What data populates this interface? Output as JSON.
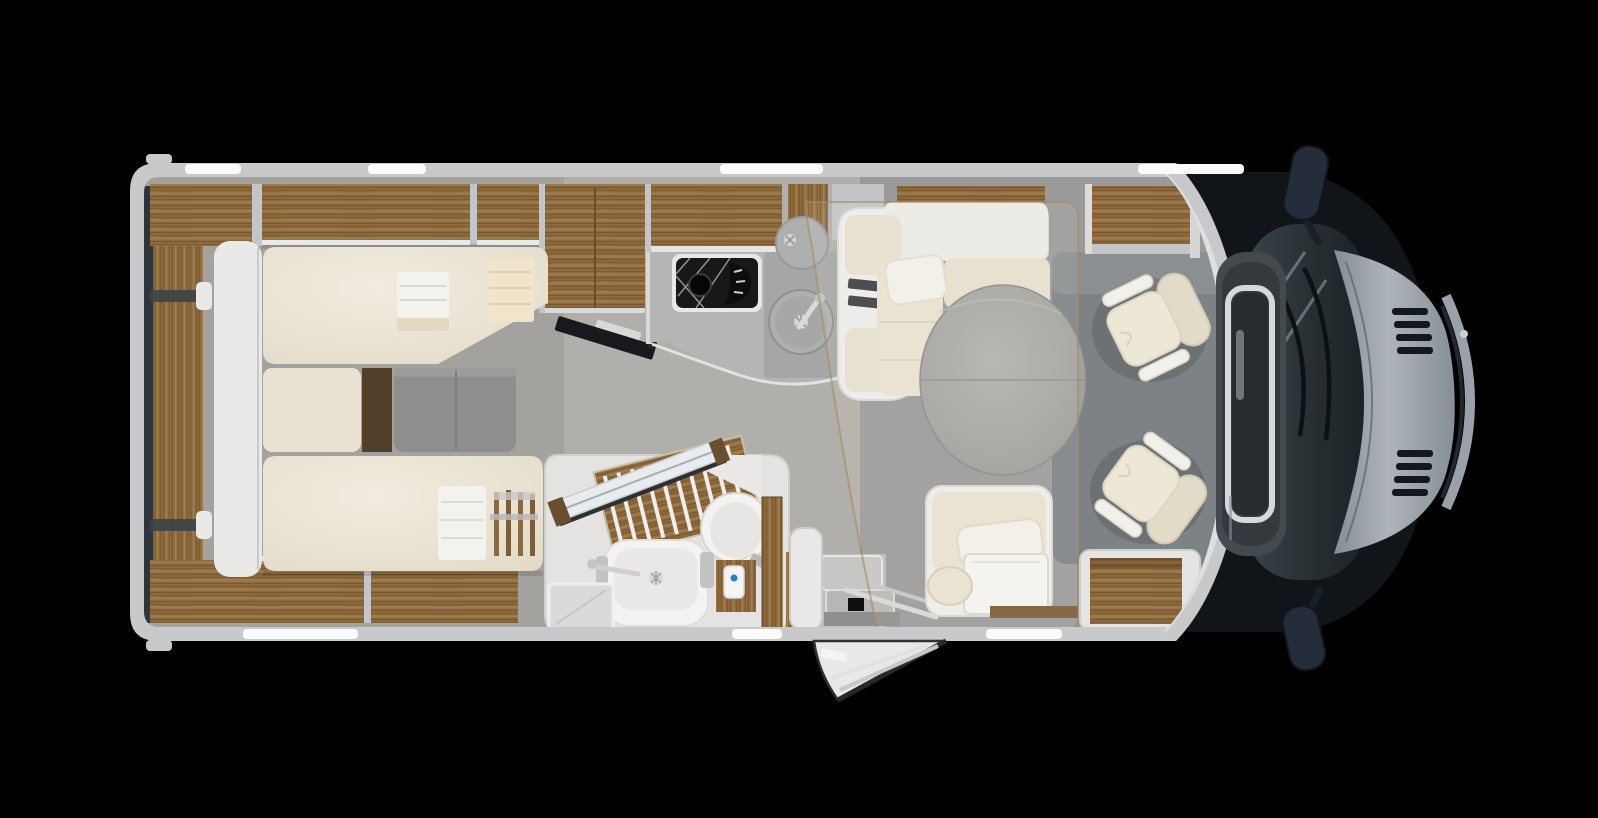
{
  "scene": {
    "name": "motorhome-floorplan-top-view",
    "view": "top-down cutaway 3D render",
    "background": "#000000"
  },
  "palette": {
    "wall": "#c7c9cb",
    "wall_light": "#dfe1e2",
    "divider": "#c3c5c7",
    "trim_white": "#e9e9e7",
    "wood": "#8d6a3e",
    "wood_dark": "#53402a",
    "wood_trim": "#7b5a36",
    "floor": "#b1afab",
    "floor_bedroom": "#a4a29f",
    "floor_lounge": "#9b9a9a",
    "rug": "#7d8286",
    "mattress": "#ece6d7",
    "cushion": "#e7e0ce",
    "cushion_deep": "#e9e2d1",
    "pillow": "#f3f1ea",
    "shell_white": "#eeeeec",
    "table": "#a6a6a4",
    "counter": "#b4b6b6",
    "counter_dark": "#a2a4a5",
    "hob_black": "#17181a",
    "sink_metal": "#aeb0b0",
    "bath_base": "#e4e3e1",
    "fixture_white": "#f4f3f1",
    "tray_grey": "#dadad8",
    "glass": "#2c3539",
    "cab_dark": "#111519",
    "hood": "#9ba3ab",
    "mirror": "#252c3a",
    "chrome": "#d6d8da",
    "belt": "#3a3d41",
    "tv": "#17191c",
    "overlay_line": "#a8895f",
    "accent_blue": "#2e7fc1",
    "steps": "#c6c6c4",
    "mat": "#8e8e8c",
    "window_white": "#fbfbfb",
    "shadow": "#2e343b",
    "gray_bench": "#8f8e8c",
    "entry_door": "#e8e8e6"
  },
  "exterior": {
    "windows_top": [
      {
        "x": 185,
        "w": 56
      },
      {
        "x": 368,
        "w": 58
      },
      {
        "x": 720,
        "w": 103
      },
      {
        "x": 1138,
        "w": 106
      }
    ],
    "windows_bottom": [
      {
        "x": 243,
        "w": 115
      },
      {
        "x": 732,
        "w": 50
      },
      {
        "x": 986,
        "w": 76
      }
    ],
    "mirrors": [
      "top-side-mirror",
      "bottom-side-mirror"
    ],
    "entry_door_state": "open"
  },
  "legend": {
    "bedroom": "rear bedroom: wardrobes, double bed with towels, grey foot bench, TV",
    "bathroom": "washroom: wooden shower grate, washbasin, toilet, open door",
    "kitchen": "kitchenette: gas hob, round sink with tap, overhead lockers",
    "lounge": "half-dinette: L-bench with seat belts, round table, side seat, drop-down-bed outline",
    "cab": "driver cab: two swivel captain chairs, windscreen, bonnet, wing mirrors",
    "entrance": "entry with steps and open door"
  }
}
